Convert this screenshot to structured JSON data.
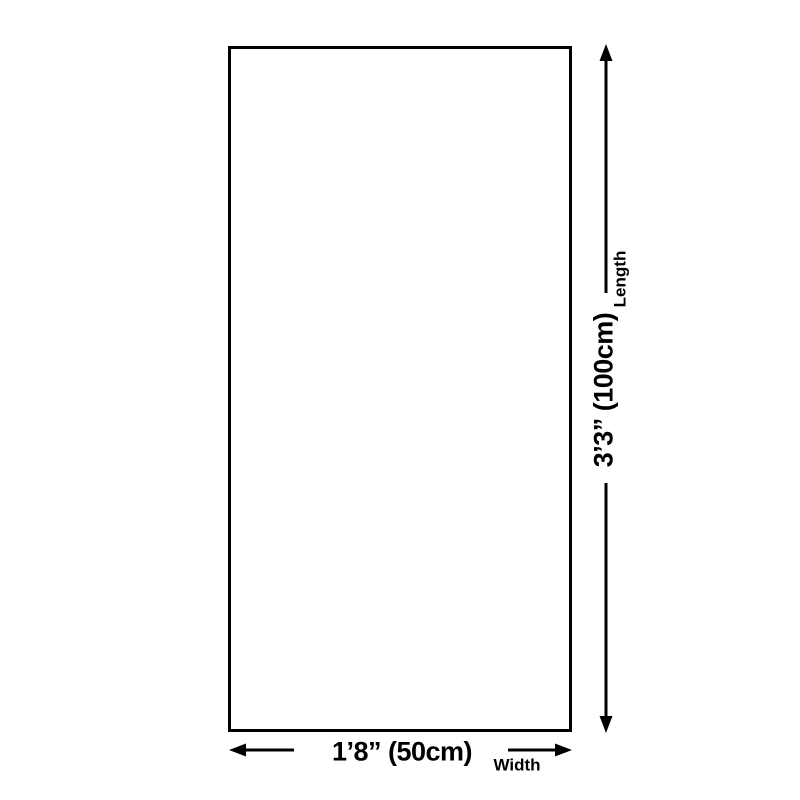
{
  "diagram": {
    "colors": {
      "background": "#ffffff",
      "line": "#000000",
      "text": "#000000"
    },
    "length_dimension": {
      "value": "3’3” (100cm)",
      "label": "Length"
    },
    "width_dimension": {
      "value": "1’8” (50cm)",
      "label": "Width"
    }
  }
}
